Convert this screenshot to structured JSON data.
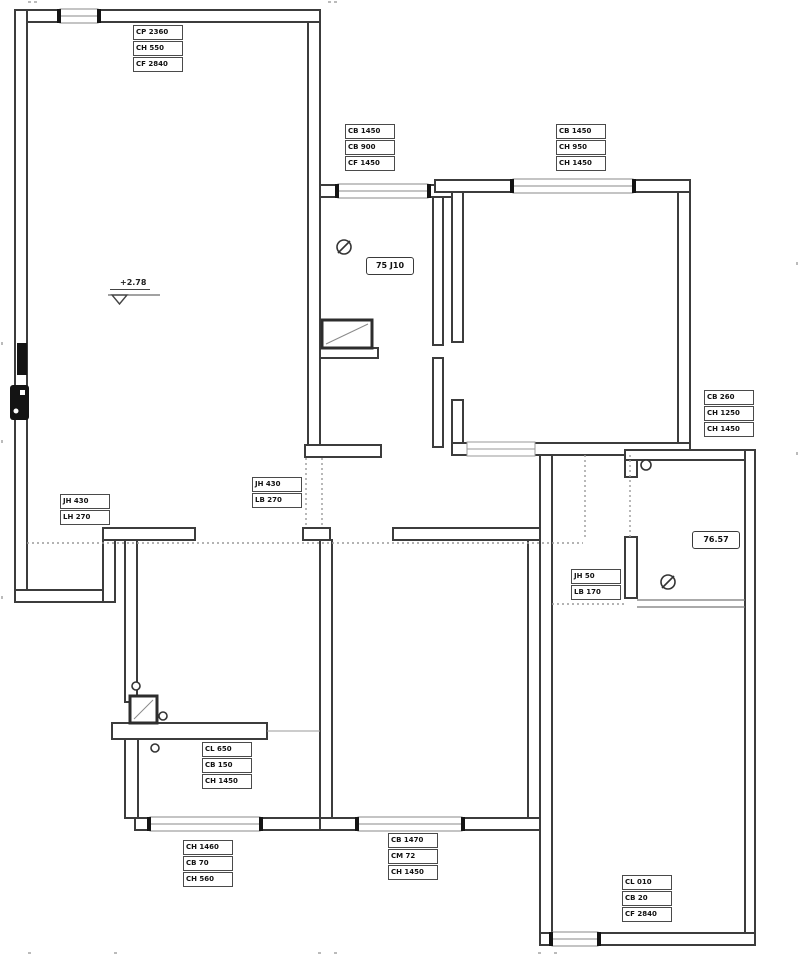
{
  "title": "apartment floor plan",
  "colors": {
    "wall_line": "#3c3c3c",
    "thin_line": "#8a8a8a",
    "dotted_line": "#9a9a9a",
    "opening_cap": "#141414",
    "label_text": "#111111",
    "background": "#ffffff"
  },
  "elevation_marker": "+2.78",
  "room_tags": {
    "bathroom": "75 J10",
    "suite": "76.57"
  },
  "label_boxes": [
    {
      "name": "top-left",
      "rows": [
        "CP 2360",
        "CH 550",
        "CF 2840"
      ]
    },
    {
      "name": "top-middle",
      "rows": [
        "CB 1450",
        "CB 900",
        "CF 1450"
      ]
    },
    {
      "name": "top-right",
      "rows": [
        "CB 1450",
        "CH 950",
        "CH 1450"
      ]
    },
    {
      "name": "right",
      "rows": [
        "CB 260",
        "CH 1250",
        "CH 1450"
      ]
    },
    {
      "name": "hall-left",
      "rows": [
        "JH 430",
        "LH 270"
      ]
    },
    {
      "name": "hall-middle",
      "rows": [
        "JH 430",
        "LB 270"
      ]
    },
    {
      "name": "hall-right",
      "rows": [
        "JH 50",
        "LB 170"
      ]
    },
    {
      "name": "bottom-left-mid",
      "rows": [
        "CL 650",
        "CB 150",
        "CH 1450"
      ]
    },
    {
      "name": "bottom-left",
      "rows": [
        "CH 1460",
        "CB 70",
        "CH 560"
      ]
    },
    {
      "name": "bottom-middle",
      "rows": [
        "CB 1470",
        "CM 72",
        "CH 1450"
      ]
    },
    {
      "name": "bottom-right",
      "rows": [
        "CL 010",
        "CB 20",
        "CF 2840"
      ]
    }
  ]
}
